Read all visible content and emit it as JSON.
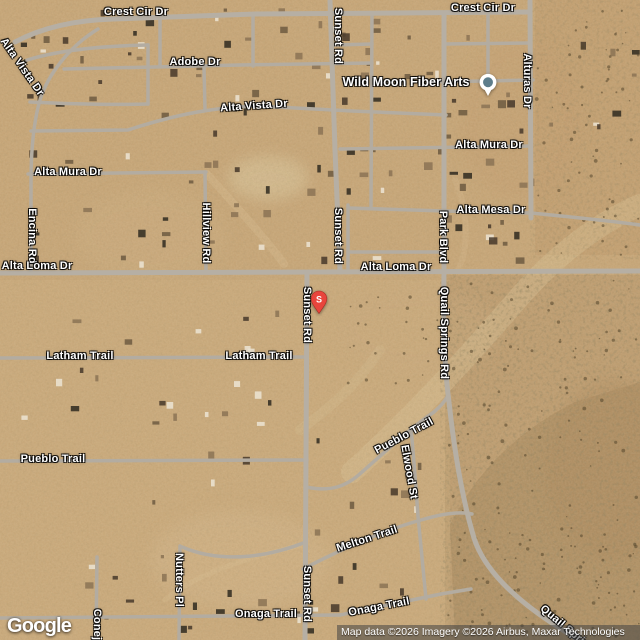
{
  "brand": {
    "logo": "Google"
  },
  "attribution": {
    "text": "Map data ©2026 Imagery ©2026 Airbus, Maxar Technologies"
  },
  "marker": {
    "label": "S"
  },
  "poi": {
    "label": "Wild Moon Fiber Arts"
  },
  "street_labels": [
    {
      "text": "Crest Cir Dr"
    },
    {
      "text": "Crest Cir Dr"
    },
    {
      "text": "Alta Vista Dr"
    },
    {
      "text": "Adobe Dr"
    },
    {
      "text": "Alta Vista Dr"
    },
    {
      "text": "Sunset Rd"
    },
    {
      "text": "Alturas Dr"
    },
    {
      "text": "Alta Mura Dr"
    },
    {
      "text": "Alta Mura Dr"
    },
    {
      "text": "Alta Mesa Dr"
    },
    {
      "text": "Sunset Rd"
    },
    {
      "text": "Park Blvd"
    },
    {
      "text": "Encina Rd"
    },
    {
      "text": "Hillview Rd"
    },
    {
      "text": "Alta Loma Dr"
    },
    {
      "text": "Alta Loma Dr"
    },
    {
      "text": "Quail Springs Rd"
    },
    {
      "text": "Sunset Rd"
    },
    {
      "text": "Latham Trail"
    },
    {
      "text": "Latham Trail"
    },
    {
      "text": "Pueblo Trail"
    },
    {
      "text": "Pueblo Trail"
    },
    {
      "text": "Elwood St"
    },
    {
      "text": "Melton Trail"
    },
    {
      "text": "Nutters Pl"
    },
    {
      "text": "Sunset Rd"
    },
    {
      "text": "Onaga Trail"
    },
    {
      "text": "Onaga Trail"
    },
    {
      "text": "Conejo"
    },
    {
      "text": "Quail Springs Rd"
    }
  ]
}
